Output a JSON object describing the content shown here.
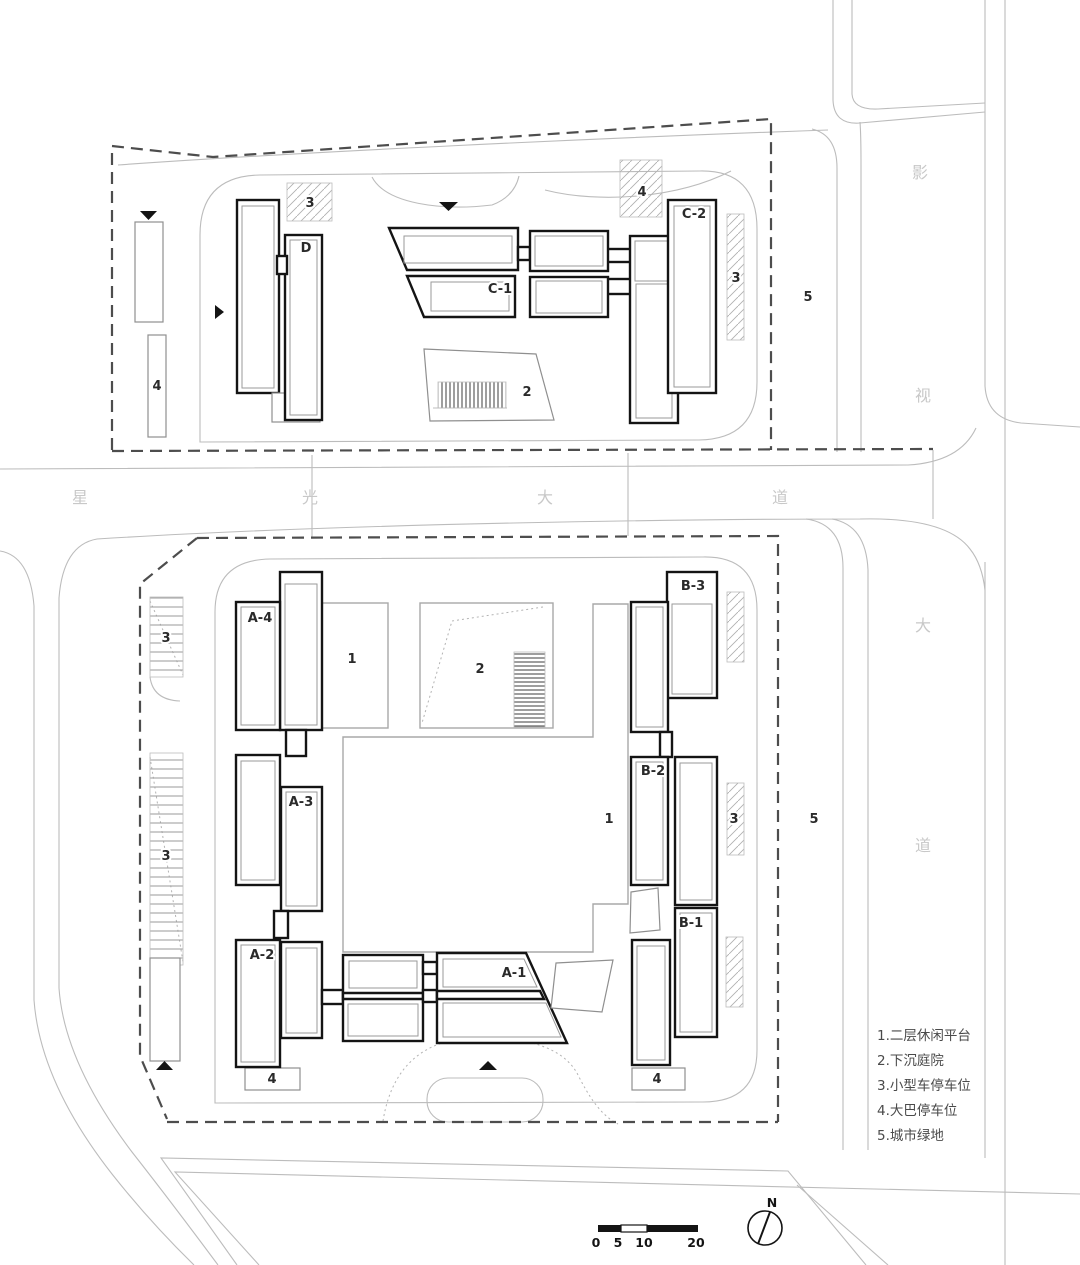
{
  "streets": {
    "xingguang": {
      "name": "星光大道",
      "chars": [
        "星",
        "光",
        "大",
        "道"
      ]
    },
    "yingshi": {
      "name": "影视大道",
      "chars": [
        "影",
        "视",
        "大",
        "道"
      ]
    }
  },
  "buildings": {
    "d": "D",
    "c1": "C-1",
    "c2": "C-2",
    "a1": "A-1",
    "a2": "A-2",
    "a3": "A-3",
    "a4": "A-4",
    "b1": "B-1",
    "b2": "B-2",
    "b3": "B-3"
  },
  "areas": {
    "platform": "1",
    "courtyard": "2",
    "parking_small": "3",
    "parking_bus": "4",
    "green": "5"
  },
  "legend": {
    "items": [
      "1.二层休闲平台",
      "2.下沉庭院",
      "3.小型车停车位",
      "4.大巴停车位",
      "5.城市绿地"
    ]
  },
  "scale_bar": {
    "ticks": [
      "0",
      "5",
      "10",
      "20"
    ]
  },
  "north_arrow": {
    "label": "N"
  },
  "colors": {
    "building_outline": "#141414",
    "road_line": "#bcbcbc",
    "boundary_dash": "#4d4d4d",
    "street_text": "#c8c8c8",
    "label_text": "#2a2a2a",
    "legend_text": "#4a4a4a"
  }
}
